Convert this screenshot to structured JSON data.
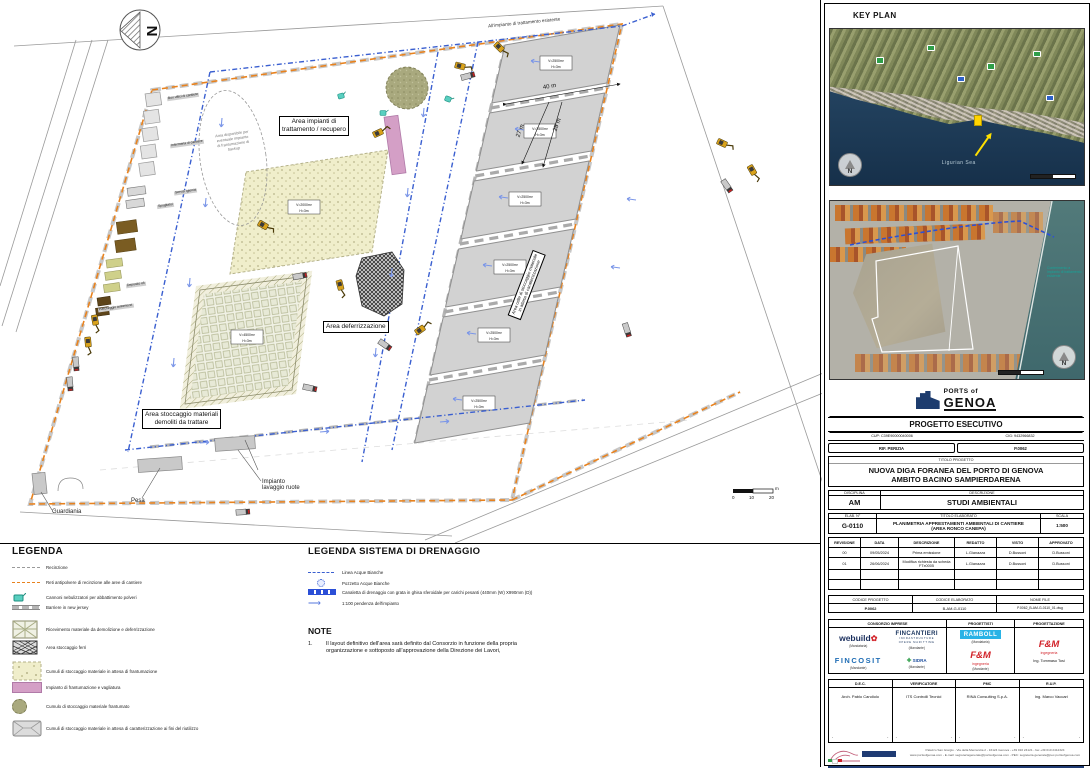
{
  "plan": {
    "north_letter": "N",
    "offsite_line_label": "All'impianto di trattamento esistente",
    "area_impianti_1": "Area impianti di",
    "area_impianti_2": "trattamento /  recupero",
    "cloud_1": "Area disponibile per",
    "cloud_2": "eventuale impianto",
    "cloud_3": "di frantumazione di",
    "cloud_4": "backup",
    "area_deferrizzazione": "Area deferrizzazione",
    "area_stoccaggio_1": "Area stoccaggio materiali",
    "area_stoccaggio_2": "demoliti da trattare",
    "celle_1": "Area celle di stoccaggio materiale",
    "celle_2": "in attesa di caratterizzazione",
    "cell_volume": "V=2500m³",
    "cell_height": "H=3m",
    "yellow_volume": "V=2000m³",
    "yellow_height": "H=3m",
    "square_volume": "V=4500m³",
    "square_height": "H=3m",
    "dim_40": "40 m",
    "dim_27": "27 m",
    "dim_25": "25 m",
    "pesa": "Pesa",
    "lavaggio_1": "Impianto",
    "lavaggio_2": "lavaggio ruote",
    "guardiania": "Guardiania",
    "facilities": [
      "Box uffici di cantiere",
      "Infermeria di cantiere",
      "Servizi igienici",
      "Spogliatoi",
      "Deposito oli",
      "Parcheggio automezzi"
    ],
    "scalebar": {
      "t0": "0",
      "t1": "10",
      "t2": "20",
      "unit": "m"
    }
  },
  "legend": {
    "title": "LEGENDA",
    "items": [
      "Recinzione",
      "Reti antipolvere di recinzione alle aree di cantiere",
      "Cannoni nebulizzatori per abbattimento polveri",
      "Barriere in new jersey",
      "Ricevimento materiale da  demolizione e deferrizzazione",
      "Area stoccaggio ferri",
      "Cumuli di stoccaggio materiale in attesa di frantumazione",
      "Impianto di frantumazione e vagliatura",
      "Cumulo di stoccaggio materiale frantumato",
      "Cumuli di stoccaggio materiale in attesa di caratterizzazione ai fini del riutilizzo"
    ]
  },
  "drainage_legend": {
    "title": "LEGENDA SISTEMA DI DRENAGGIO",
    "items": [
      "Linea Acque Bianche",
      "Pozzetto Acque Bianche",
      "Canaletta di drenaggio con grata in ghisa sferoidale per carichi pesanti  (440mm (W) X990mm (D))",
      "1:100 pendenza dell'impianto"
    ]
  },
  "notes": {
    "title": "NOTE",
    "num": "1.",
    "text": "Il layout definitivo dell'area sarà definito dal Consorzio in funzione della propria organizzazione e sottoposto all'approvazione della Direzione dei Lavori,"
  },
  "keyplan": {
    "title": "KEY PLAN",
    "sea": "Ligurian Sea",
    "north": "N",
    "callout": "Conferimento a impianto di trattamento esistente"
  },
  "titleblock": {
    "logo_top": "PORTS of",
    "logo_main": "GENOA",
    "stage": "PROGETTO ESECUTIVO",
    "cup": "CUP: C39E90000040006",
    "cig": "CIG: 9432966832",
    "rif": "RIF. PERIZIA",
    "rif_value": "P.0062",
    "titolo_header": "TITOLO PROGETTO",
    "title_line1": "NUOVA DIGA FORANEA DEL PORTO DI GENOVA",
    "title_line2": "AMBITO BACINO SAMPIERDARENA",
    "disciplina_header": "DISCIPLINA",
    "descrizione_header": "DESCRIZIONE",
    "disciplina": "AM",
    "descrizione": "STUDI AMBIENTALI",
    "elab_header": "ELAB. N°",
    "titolo_elaborato_header": "TITOLO ELABORATO",
    "scala_header": "SCALA",
    "elab": "G-0110",
    "titolo_elaborato_1": "PLANIMETRIA APPRESTAMENTI AMBIENTALI DI CANTIERE",
    "titolo_elaborato_2": "(AREA RONCO CANEPA)",
    "scala": "1:500",
    "rev_headers": [
      "REVISIONE",
      "DATA",
      "DESCRIZIONE",
      "REDATTO",
      "VISTO",
      "APPROVATO"
    ],
    "rev_rows": [
      [
        "00",
        "09/05/2024",
        "Prima emissione",
        "L.Gianazza",
        "D.Bussoni",
        "D.Bussoni"
      ],
      [
        "01",
        "26/06/2024",
        "Modifica richiesta da scheda FTx0005",
        "L.Gianazza",
        "D.Bussoni",
        "D.Bussoni"
      ]
    ],
    "codice_progetto_header": "CODICE PROGETTO",
    "codice_elaborato_header": "CODICE ELABORATO",
    "nome_file_header": "NOME FILE",
    "codice_progetto": "P.0062",
    "codice_elaborato": "B-AM-G-0110",
    "nome_file": "P.0062_B-AM-G-0110_01.dwg",
    "consorzio_header": "CONSORZIO IMPRESE",
    "progettisti_header": "PROGETTISTI",
    "progettazione_header": "PROGETTAZIONE",
    "logos": {
      "webuild": "webuild",
      "webuild_tag": "(Mandataria)",
      "fincantieri": "FINCANTIERI",
      "fincantieri_sub1": "INFRASTRUCTURE",
      "fincantieri_sub2": "OPERE MARITTIME",
      "fincantieri_tag": "(Mandante)",
      "fincosit": "FINCOSIT",
      "fincosit_tag": "(Mandante)",
      "sidra": "SIDRA",
      "sidra_tag": "(Mandante)",
      "ramboll": "RAMBOLL",
      "ramboll_tag": "(Mandataria)",
      "fm": "F&M",
      "fm_sub": "ingegneria",
      "fm_tag": "(Mandante)",
      "fm_engineer": "Ing. Tommaso Tosi"
    },
    "dec_header": "D.E.C.",
    "verificatore_header": "VERIFICATORE",
    "pmc_header": "PMC",
    "rup_header": "R.U.P.",
    "dec": "Arch. Pablo Candiolo",
    "verificatore": "ITS Controlli Tecnici",
    "pmc": "RINA Consulting S.p.A.",
    "rup": "Ing. Marco Vaccari",
    "footer_line1": "Palazzo San Giorgio - Via della Mercanzia 2 - 16124 Genova - +39 010 24121 - fax +39 010 2412324",
    "footer_line2": "www.portsofgenoa.com - E-mail: segreteriagenerale@portsofgenoa.com - PEC: segreteria.generale@pec.portsofgenoa.com"
  }
}
